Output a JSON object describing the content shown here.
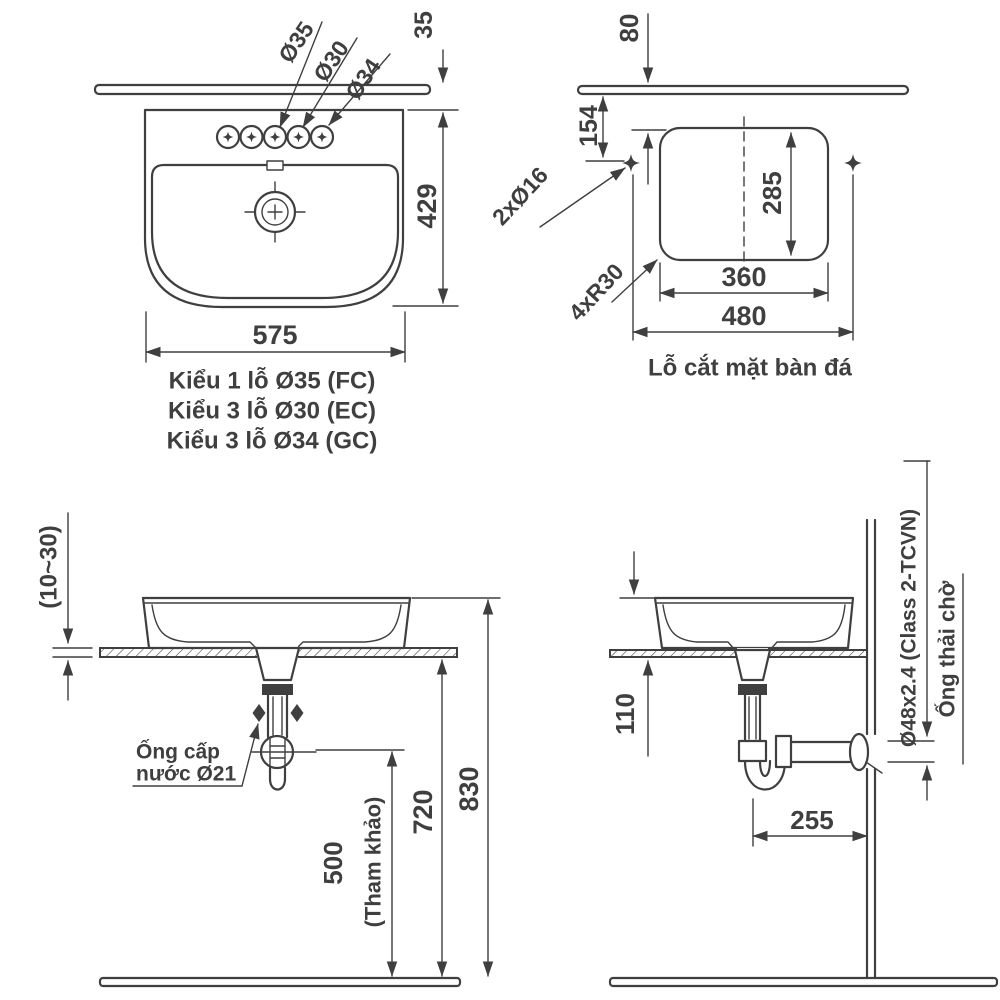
{
  "colors": {
    "line": "#3f3f3f",
    "background": "#ffffff"
  },
  "plan_view": {
    "hole_labels": [
      "Ø35",
      "Ø30",
      "Ø34"
    ],
    "dim_wall_gap": "35",
    "dim_depth": "429",
    "dim_width": "575",
    "captions": [
      "Kiểu 1 lỗ Ø35 (FC)",
      "Kiểu 3 lỗ Ø30 (EC)",
      "Kiểu 3 lỗ Ø34 (GC)"
    ]
  },
  "cutout_view": {
    "dim_wall_gap": "80",
    "dim_hole_offset": "154",
    "dim_height": "285",
    "dim_width": "360",
    "dim_hole_span": "480",
    "label_holes": "2xØ16",
    "label_radius": "4xR30",
    "caption": "Lỗ cắt mặt bàn đá"
  },
  "front_view": {
    "dim_counter_thickness": "(10~30)",
    "label_supply_1": "Ống cấp",
    "label_supply_2": "nước Ø21",
    "dim_supply_height": "500",
    "dim_supply_note": "(Tham khảo)",
    "dim_counter_height": "720",
    "dim_rim_height": "830"
  },
  "side_view": {
    "dim_drain_drop": "110",
    "dim_trap_offset": "255",
    "label_drain_pipe": "Ø48x2.4 (Class 2-TCVN)",
    "label_waste_stub": "Ống thải chờ"
  }
}
